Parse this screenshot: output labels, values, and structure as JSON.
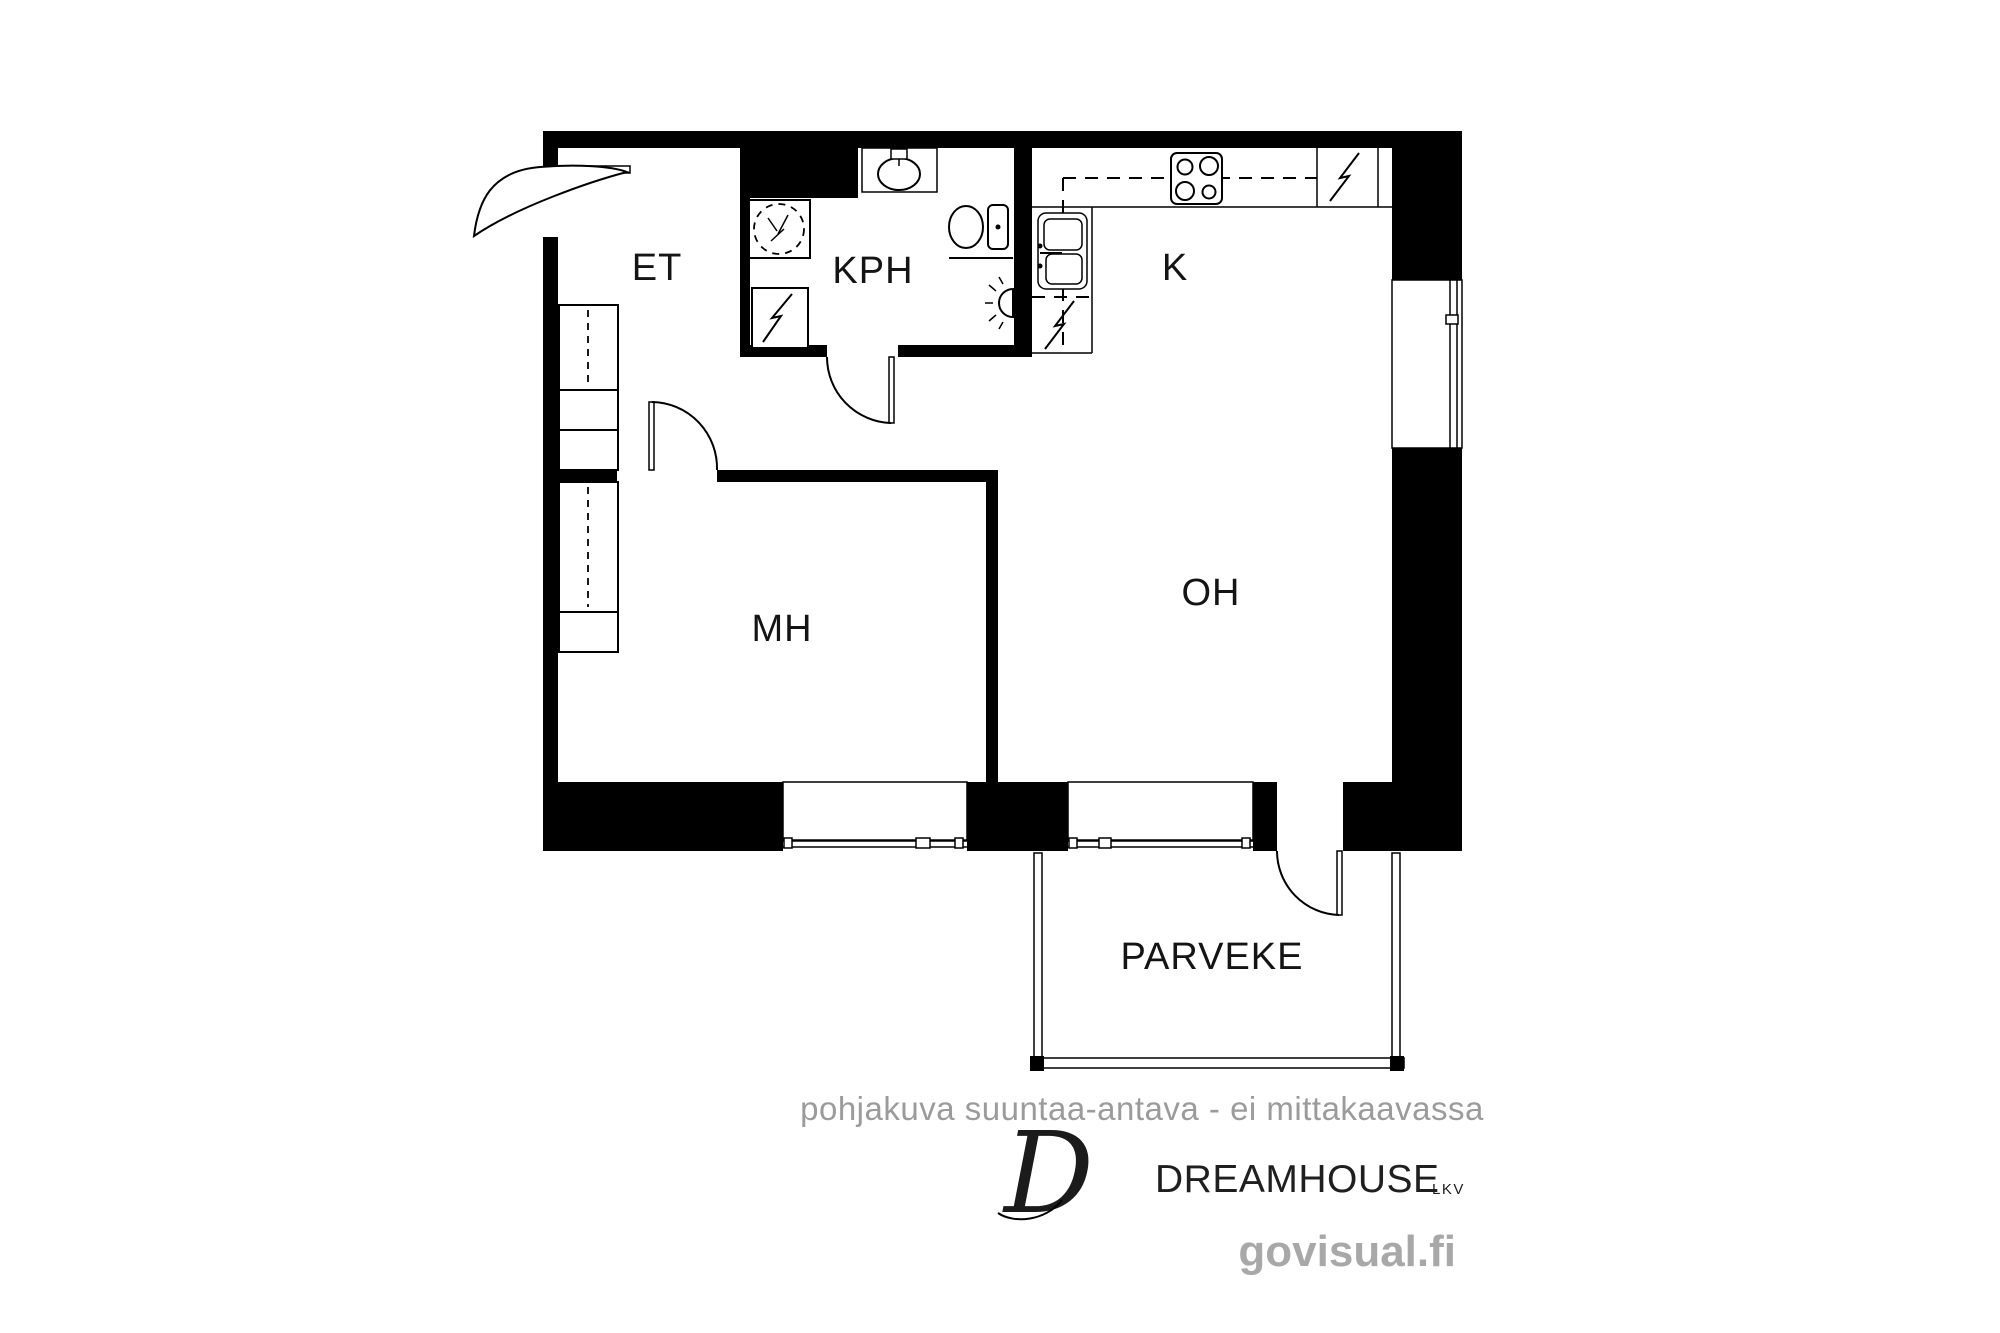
{
  "canvas": {
    "width": 2000,
    "height": 1333,
    "background": "#ffffff"
  },
  "colors": {
    "wall": "#000000",
    "line": "#000000",
    "room_label": "#141414",
    "disclaimer_text": "#9b9b9b",
    "watermark_text": "#a8a8a8",
    "logo_text": "#1f1f1f"
  },
  "floorplan": {
    "rooms": [
      {
        "id": "et",
        "label": "ET"
      },
      {
        "id": "kph",
        "label": "KPH"
      },
      {
        "id": "k",
        "label": "K"
      },
      {
        "id": "oh",
        "label": "OH"
      },
      {
        "id": "mh",
        "label": "MH"
      },
      {
        "id": "parveke",
        "label": "PARVEKE"
      }
    ],
    "fixtures": [
      "entry-door",
      "bathroom-door",
      "bedroom-door",
      "balcony-door",
      "washing-machine",
      "electric-appliance-bathroom",
      "bathroom-sink",
      "toilet",
      "towel-rail",
      "wall-light",
      "stove",
      "electric-appliance-kitchen",
      "kitchen-sink",
      "dishwasher",
      "wardrobes",
      "window-bedroom",
      "window-livingroom",
      "window-kitchen",
      "balcony-railing"
    ],
    "disclaimer": "pohjakuva suuntaa-antava - ei mittakaavassa"
  },
  "branding": {
    "monogram": "D",
    "name": "DREAMHOUSE",
    "suffix": "LKV",
    "watermark": "govisual.fi"
  }
}
